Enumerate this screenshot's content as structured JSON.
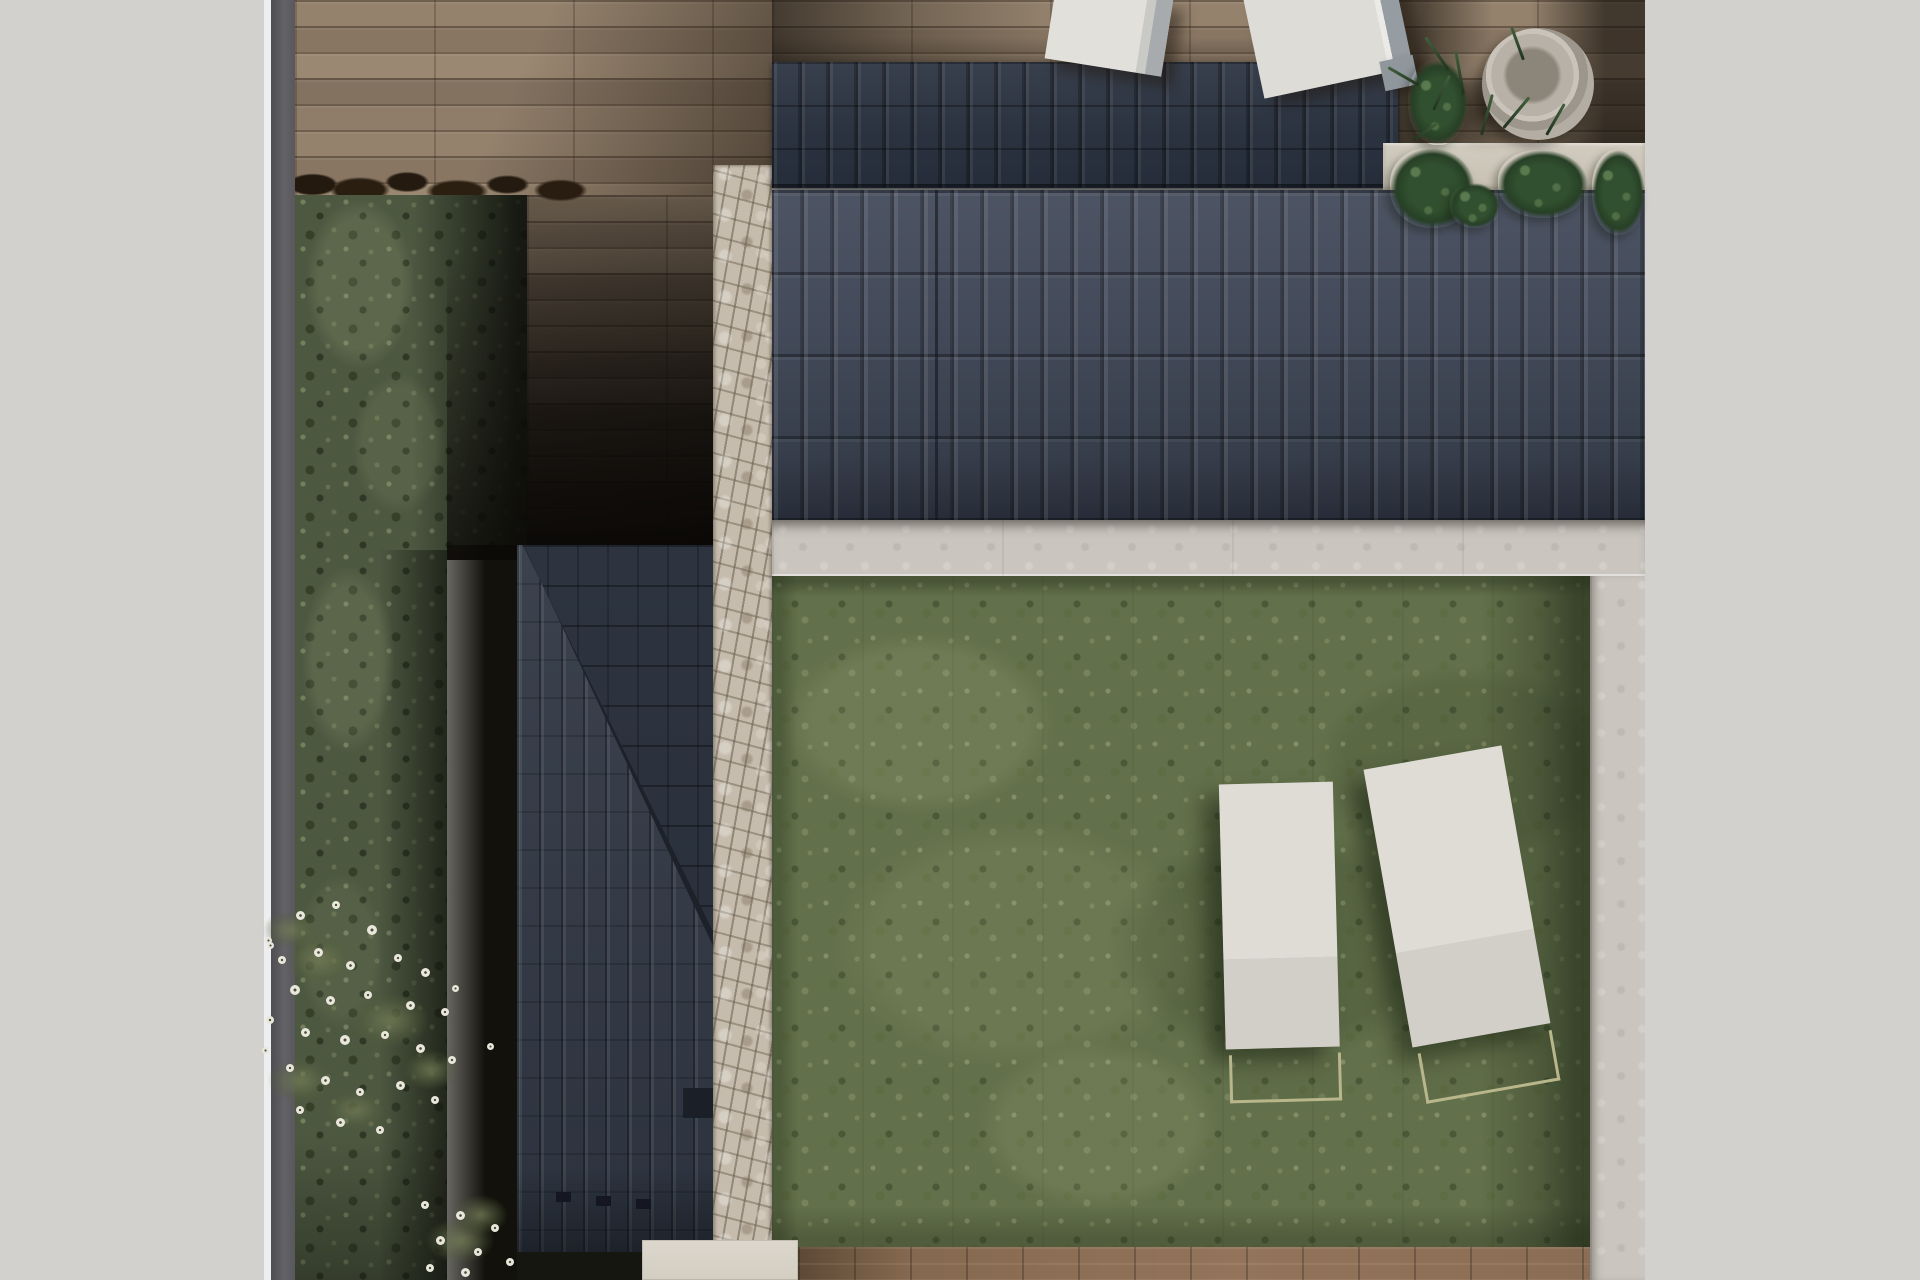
{
  "meta": {
    "description": "Top-down 3D architectural render of a house plot: dark tiled roofs, wooden deck terrace, stone wall, concrete walkways, lawn with two white sun loungers, hedge strip with white flowers, potted plants",
    "width": 1920,
    "height": 1280,
    "visible_text": ""
  },
  "palette": {
    "page_background": "#d3d1cd",
    "boundary_wall_gray": "#5a595e",
    "deck_wood_tan": "#8f7d69",
    "deck_wood_shadow": "#2a211a",
    "roof_dark_navy": "#2b3340",
    "roof_slate": "#434a59",
    "roof_lower": "#333a46",
    "stone_wall_beige": "#c6bcad",
    "concrete_walkway": "#cac6bf",
    "concrete_block": "#d7d2c7",
    "lawn_green": "#62704b",
    "hedge_green": "#4d5841",
    "lounger_white": "#dedbd5",
    "lounger_frame_tan": "#b9b68c",
    "flower_white": "#e9e7db",
    "plant_dark_green": "#2c432e",
    "soil_dark_brown": "#261b10"
  },
  "scene_objects": [
    "boundary-wall",
    "wood-deck-terrace",
    "hedge-strip",
    "flower-bed",
    "lower-roof-with-hip-ridge",
    "stone-wall",
    "upper-roof",
    "main-roof",
    "planter-strip",
    "concrete-walkway-horizontal",
    "concrete-walkway-vertical",
    "lawn",
    "sun-lounger-left",
    "sun-lounger-right",
    "deck-cushion-left",
    "deck-cushion-right",
    "round-planter-pot",
    "monstera-plants",
    "bottom-wood-strip",
    "concrete-slab"
  ],
  "flowers": [
    [
      300,
      915,
      9
    ],
    [
      336,
      905,
      8
    ],
    [
      372,
      930,
      10
    ],
    [
      318,
      952,
      9
    ],
    [
      282,
      960,
      8
    ],
    [
      350,
      965,
      9
    ],
    [
      398,
      958,
      8
    ],
    [
      425,
      972,
      9
    ],
    [
      295,
      990,
      10
    ],
    [
      330,
      1000,
      9
    ],
    [
      368,
      995,
      8
    ],
    [
      410,
      1005,
      9
    ],
    [
      445,
      1012,
      8
    ],
    [
      270,
      1020,
      8
    ],
    [
      305,
      1032,
      9
    ],
    [
      345,
      1040,
      10
    ],
    [
      385,
      1035,
      8
    ],
    [
      420,
      1048,
      9
    ],
    [
      452,
      1060,
      8
    ],
    [
      290,
      1068,
      8
    ],
    [
      325,
      1080,
      9
    ],
    [
      360,
      1092,
      8
    ],
    [
      400,
      1085,
      9
    ],
    [
      435,
      1100,
      8
    ],
    [
      300,
      1110,
      8
    ],
    [
      340,
      1122,
      9
    ],
    [
      380,
      1130,
      8
    ],
    [
      270,
      945,
      7
    ],
    [
      455,
      988,
      7
    ],
    [
      268,
      940,
      7
    ],
    [
      265,
      1050,
      7
    ],
    [
      425,
      1205,
      8
    ],
    [
      460,
      1215,
      9
    ],
    [
      495,
      1228,
      8
    ],
    [
      440,
      1240,
      9
    ],
    [
      478,
      1252,
      8
    ],
    [
      510,
      1262,
      8
    ],
    [
      430,
      1268,
      8
    ],
    [
      465,
      1272,
      9
    ],
    [
      490,
      1046,
      7
    ]
  ],
  "leaf_clumps": [
    [
      320,
      960,
      70,
      50
    ],
    [
      390,
      1020,
      80,
      55
    ],
    [
      300,
      1080,
      65,
      45
    ],
    [
      430,
      1070,
      55,
      40
    ],
    [
      355,
      1110,
      60,
      40
    ],
    [
      460,
      1240,
      70,
      45
    ],
    [
      290,
      930,
      55,
      38
    ],
    [
      480,
      1215,
      55,
      40
    ]
  ],
  "plants": [
    [
      1390,
      148,
      85,
      80
    ],
    [
      1498,
      150,
      90,
      68
    ],
    [
      1592,
      150,
      53,
      85
    ],
    [
      1450,
      183,
      50,
      45
    ],
    [
      1408,
      60,
      60,
      85
    ]
  ],
  "blades": [
    [
      1447,
      70,
      40,
      -35
    ],
    [
      1462,
      95,
      45,
      -10
    ],
    [
      1432,
      110,
      38,
      25
    ],
    [
      1417,
      85,
      35,
      -60
    ],
    [
      1502,
      128,
      40,
      40
    ],
    [
      1522,
      60,
      35,
      -20
    ],
    [
      1480,
      135,
      42,
      15
    ],
    [
      1412,
      140,
      30,
      55
    ],
    [
      1545,
      135,
      36,
      30
    ]
  ],
  "roof_vents": [
    [
      556,
      1192
    ],
    [
      596,
      1196
    ],
    [
      636,
      1199
    ]
  ]
}
